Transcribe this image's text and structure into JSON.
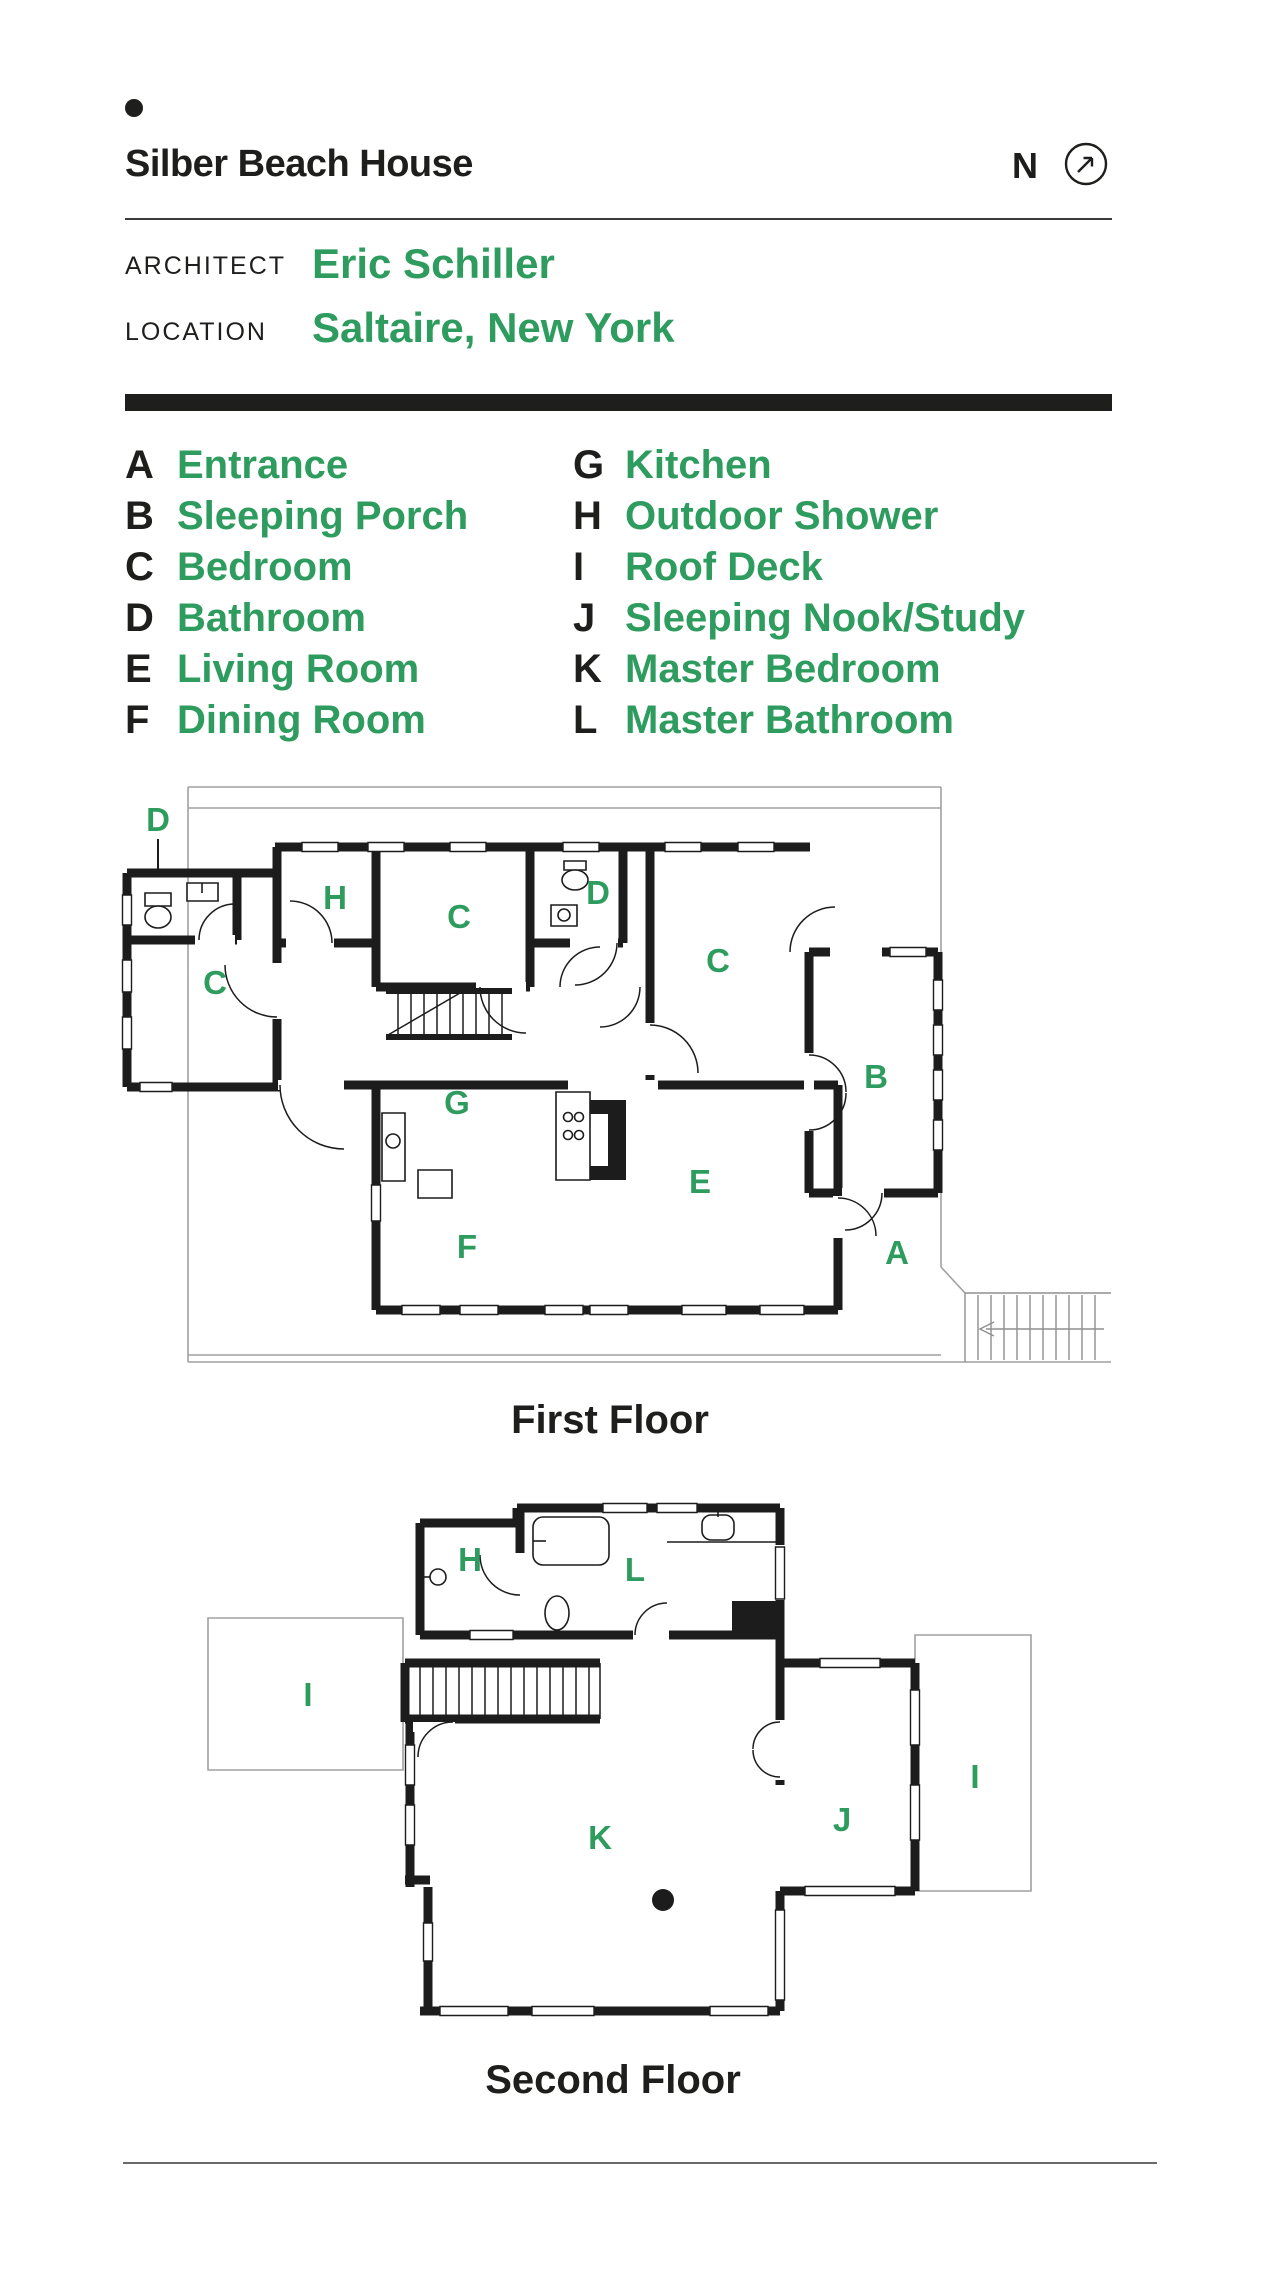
{
  "header": {
    "title": "Silber Beach House",
    "compass_letter": "N",
    "architect_label": "ARCHITECT",
    "architect_name": "Eric Schiller",
    "location_label": "LOCATION",
    "location_name": "Saltaire, New York"
  },
  "colors": {
    "accent_green": "#2E9C5E",
    "ink": "#1e1e1c",
    "deck_gray": "#a0a0a0"
  },
  "legend": {
    "column1": [
      {
        "key": "A",
        "name": "Entrance"
      },
      {
        "key": "B",
        "name": "Sleeping Porch"
      },
      {
        "key": "C",
        "name": "Bedroom"
      },
      {
        "key": "D",
        "name": "Bathroom"
      },
      {
        "key": "E",
        "name": "Living Room"
      },
      {
        "key": "F",
        "name": "Dining Room"
      }
    ],
    "column2": [
      {
        "key": "G",
        "name": "Kitchen"
      },
      {
        "key": "H",
        "name": "Outdoor Shower"
      },
      {
        "key": "I",
        "name": "Roof Deck"
      },
      {
        "key": "J",
        "name": "Sleeping Nook/Study"
      },
      {
        "key": "K",
        "name": "Master Bedroom"
      },
      {
        "key": "L",
        "name": "Master Bathroom"
      }
    ]
  },
  "floors": {
    "first": {
      "caption": "First Floor",
      "labels": [
        {
          "letter": "D"
        },
        {
          "letter": "C"
        },
        {
          "letter": "H"
        },
        {
          "letter": "C"
        },
        {
          "letter": "D"
        },
        {
          "letter": "C"
        },
        {
          "letter": "B"
        },
        {
          "letter": "G"
        },
        {
          "letter": "E"
        },
        {
          "letter": "F"
        },
        {
          "letter": "A"
        }
      ]
    },
    "second": {
      "caption": "Second Floor",
      "labels": [
        {
          "letter": "H"
        },
        {
          "letter": "L"
        },
        {
          "letter": "I"
        },
        {
          "letter": "J"
        },
        {
          "letter": "I"
        },
        {
          "letter": "K"
        }
      ]
    }
  }
}
